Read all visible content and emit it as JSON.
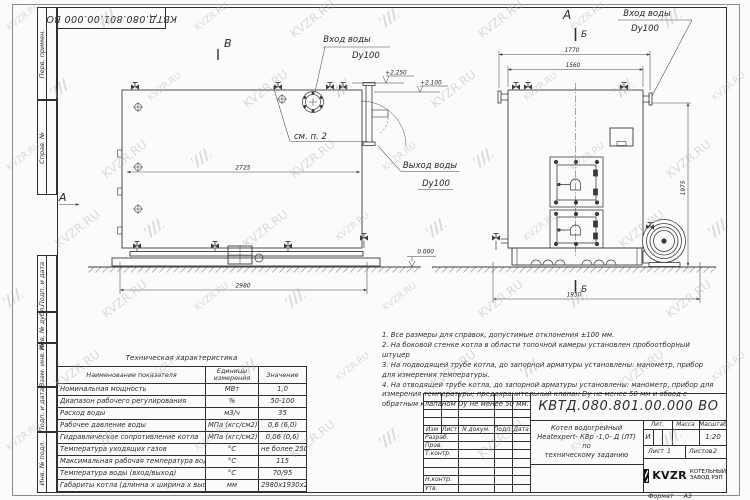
{
  "watermark": {
    "text": "KVZR.RU"
  },
  "sheet": {
    "top_doc_number": "КВТД.080.801.00.000 ВО",
    "sidebar_labels": [
      "Перв. примен.",
      "Справ. №",
      "Подп. и дата",
      "Инв. № дубл.",
      "Взам. инв. №",
      "Подп. и дата",
      "Инв. № подл."
    ],
    "format_label": "Формат",
    "format_value": "А3"
  },
  "views": {
    "side": {
      "view_letter": "В",
      "direction_letter": "А",
      "inlet_line1": "Вход воды",
      "inlet_line2": "Dy100",
      "outlet_line1": "Выход воды",
      "outlet_line2": "Dy100",
      "see_note": "см. п. 2",
      "elev_top": "+2.250",
      "elev_roof": "+2.100",
      "dim_inner_width": "2725",
      "dim_overall_width": "2980"
    },
    "front": {
      "view_letter": "А",
      "section_letter_top": "Б",
      "section_letter_bottom": "Б",
      "inlet_line1": "Вход воды",
      "inlet_line2": "Dy100",
      "dim_top_outer": "1770",
      "dim_top_inner": "1560",
      "dim_height": "1975",
      "dim_bottom_width": "1930",
      "elev_zero": "0.000"
    }
  },
  "notes": [
    "1. Все размеры для справок, допустимые отклонения ±100 мм.",
    "2. На боковой стенке котла в области топочной камеры установлен пробоотборный штуцер",
    "3. На подводящей трубе котла, до запорной арматуры установлены: манометр, прибор для измерения температуры.",
    "4. На отводящей трубе котла, до запорной арматуры установлены: манометр, прибор для измерения температуры; предохранительный клапан Dу не менее 50 мм и обвод с обратным клапаном Dу не менее 50 мм."
  ],
  "spec_table": {
    "title": "Техническая характеристика",
    "headers": [
      "Наименование показателя",
      "Единицы измерения",
      "Значение"
    ],
    "rows": [
      [
        "Номинальная мощность",
        "МВт",
        "1,0"
      ],
      [
        "Диапазон рабочего регулирования",
        "%",
        "50-100"
      ],
      [
        "Расход воды",
        "м3/ч",
        "35"
      ],
      [
        "Рабочее давление воды",
        "МПа (кгс/см2)",
        "0,6 (6,0)"
      ],
      [
        "Гидравлическое сопротивление котла",
        "МПа (кгс/см2)",
        "0,06 (0,6)"
      ],
      [
        "Температура уходящих газов",
        "°С",
        "не более 250"
      ],
      [
        "Максимальная рабочая температура воды",
        "°С",
        "115"
      ],
      [
        "Температура воды (вход/выход)",
        "°С",
        "70/95"
      ],
      [
        "Габариты котла (длинна х ширина х высота)",
        "мм",
        "2980х1930х2250"
      ]
    ]
  },
  "title_block": {
    "doc_number": "КВТД.080.801.00.000 ВО",
    "header_cols": [
      "Изм",
      "Лист",
      "N докум.",
      "Подп.",
      "Дата"
    ],
    "row_labels": [
      "Разраб.",
      "Пров.",
      "Т.контр.",
      "Н.контр.",
      "Утв."
    ],
    "title_lines": [
      "Котел водогрейный",
      "Heatexpert- КВр -1,0- Д (ЛТ) по",
      "техническому заданию"
    ],
    "lit_header": "Лит.",
    "mass_header": "Масса",
    "scale_header": "Масштаб",
    "lit_value": "И",
    "scale_value": "1:20",
    "sheet_label": "Лист",
    "sheet_value": "1",
    "sheets_label": "Листов",
    "sheets_value": "2",
    "company_logo": "KVZR",
    "company_name_1": "КОТЕЛЬНЫЙ",
    "company_name_2": "ЗАВОД РЭП"
  }
}
